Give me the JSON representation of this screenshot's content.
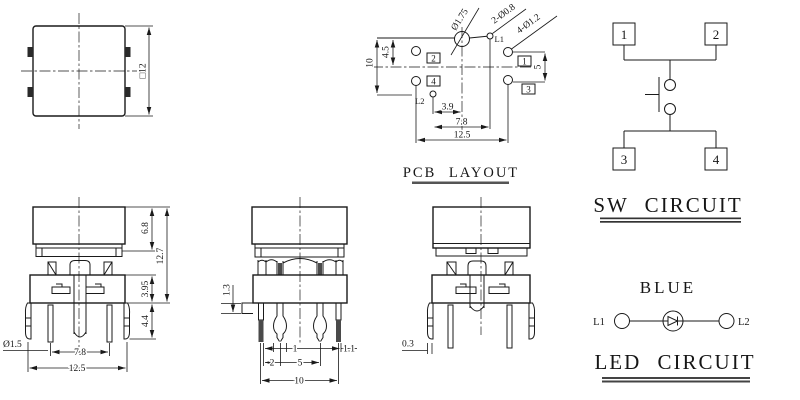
{
  "top_view": {
    "side_dim": "□12"
  },
  "pcb_layout": {
    "title": "PCB LAYOUT",
    "center_hole": "Ø1.75",
    "led_holes": "2-Ø0.8",
    "pin_holes": "4-Ø1.2",
    "l1": "L1",
    "l2": "L2",
    "pads": {
      "p1": "1",
      "p2": "2",
      "p3": "3",
      "p4": "4"
    },
    "dims": {
      "offset_top": "4.5",
      "height": "10",
      "pitch_v": "5",
      "led_offset": "3.9",
      "led_pitch": "7.8",
      "overall": "12.5"
    }
  },
  "front_view": {
    "dims": {
      "cap": "6.8",
      "total": "12.7",
      "body": "3.95",
      "pins": "4.4",
      "pin_dia": "Ø1.5",
      "pitch": "7.8",
      "overall": "12.5"
    }
  },
  "side_view": {
    "dims": {
      "standoff": "1.3",
      "pin": "1",
      "clip": "1.1",
      "edge": "2",
      "pitch": "5",
      "overall": "10"
    }
  },
  "back_view": {
    "dims": {
      "offset": "0.3"
    }
  },
  "sw_circuit": {
    "title": "SW CIRCUIT",
    "t1": "1",
    "t2": "2",
    "t3": "3",
    "t4": "4"
  },
  "led_circuit": {
    "title": "LED CIRCUIT",
    "color": "BLUE",
    "l1": "L1",
    "l2": "L2"
  }
}
